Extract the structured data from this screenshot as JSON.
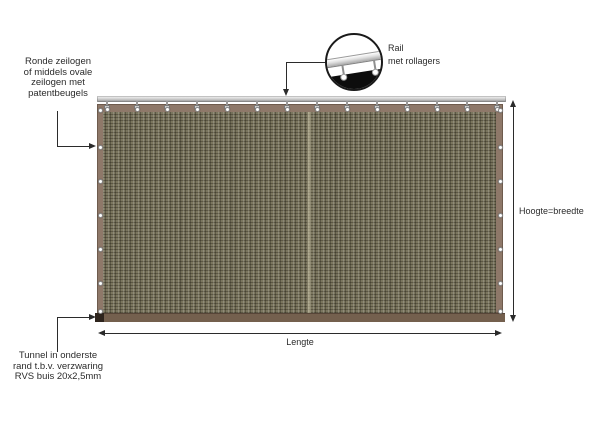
{
  "title": "Zeildoek met railsysteem - technische tekening",
  "labels": {
    "eyelets": {
      "lines": [
        "Ronde zeilogen",
        "of middels ovale",
        "zeilogen met",
        "patentbeugels"
      ]
    },
    "rail": {
      "lines": [
        "Rail",
        "met rollagers"
      ]
    },
    "height_dim": "Hoogte=breedte",
    "length_dim": "Lengte",
    "tunnel": {
      "lines": [
        "Tunnel in onderste",
        "rand t.b.v. verzwaring",
        "RVS buis 20x2,5mm"
      ]
    }
  },
  "colors": {
    "bg": "#ffffff",
    "text": "#2b2b2b",
    "line": "#2b2b2b",
    "fabric_base": "#7b765f",
    "fabric_border": "#8e7869",
    "tunnel": "#74604e",
    "tunnel_cap": "#2e241d",
    "rail_gray": "#c4c4c4"
  },
  "fabric": {
    "hanger_count": 14,
    "hanger_start_x": 107,
    "hanger_spacing": 30,
    "top_eyelet_y": 109,
    "side_eyelet_y": [
      110,
      147,
      181,
      215,
      249,
      283,
      311
    ],
    "left_eyelet_x": 100,
    "right_eyelet_x": 500
  }
}
